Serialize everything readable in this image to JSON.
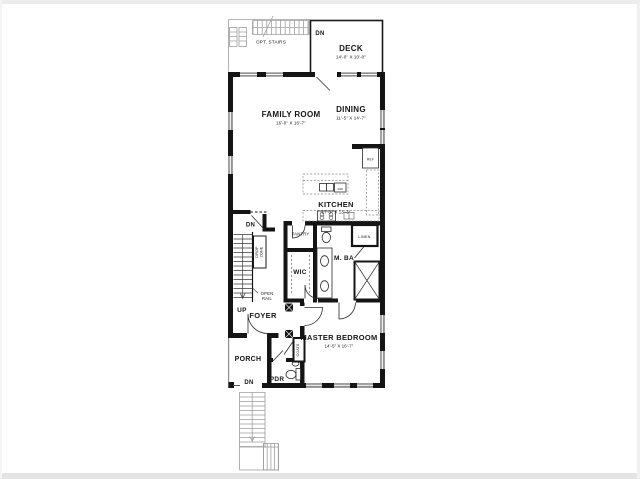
{
  "floorplan": {
    "rooms": {
      "opt_stairs": {
        "label": "OPT. STAIRS"
      },
      "deck": {
        "label": "DECK",
        "dims": "14'-0\" X 10'-0\""
      },
      "family_room": {
        "label": "FAMILY ROOM",
        "dims": "16'-0\" X 16'-7\""
      },
      "dining": {
        "label": "DINING",
        "dims": "11'-5\" X 14'-7\""
      },
      "kitchen": {
        "label": "KITCHEN",
        "dims": "17'-1\" X 13'-3\""
      },
      "pantry": {
        "label": "PANTRY"
      },
      "linen": {
        "label": "LINEN"
      },
      "wic": {
        "label": "WIC"
      },
      "master_bath": {
        "label": "M. BA"
      },
      "master_bedroom": {
        "label": "MASTER BEDROOM",
        "dims": "14'-5\" X 16'-7\""
      },
      "foyer": {
        "label": "FOYER"
      },
      "porch": {
        "label": "PORCH"
      },
      "powder_room": {
        "label": "PDR"
      },
      "coats_closet": {
        "label": "COATS"
      }
    },
    "annotations": {
      "deck_down": "DN",
      "basement_down": "DN",
      "stairs_up": "UP",
      "porch_down": "DN",
      "drop_zone_line1": "DROP",
      "drop_zone_line2": "ZONE",
      "open_rail_line1": "OPEN",
      "open_rail_line2": "RAIL",
      "refrigerator": "REF",
      "dishwasher": "DW"
    },
    "colors": {
      "wall": "#141414",
      "site_gray": "#9e9e9e",
      "background": "#ffffff"
    }
  }
}
